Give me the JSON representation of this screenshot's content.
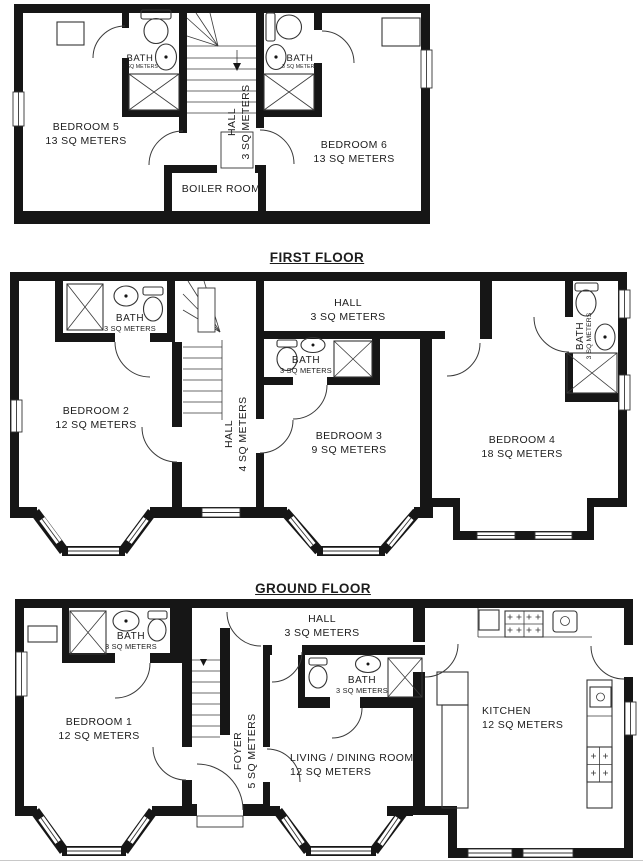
{
  "colors": {
    "wall": "#161616",
    "background": "#ffffff",
    "text": "#1c1c1c"
  },
  "headings": {
    "first_floor": "FIRST FLOOR",
    "ground_floor": "GROUND FLOOR"
  },
  "floor2": {
    "bedroom5": {
      "name": "BEDROOM 5",
      "area": "13 SQ METERS"
    },
    "bedroom6": {
      "name": "BEDROOM 6",
      "area": "13 SQ METERS"
    },
    "hall": {
      "name": "HALL",
      "area": "3 SQ METERS"
    },
    "boiler_room": {
      "name": "BOILER ROOM"
    },
    "bath_left": {
      "name": "BATH",
      "area": "3 SQ METERS"
    },
    "bath_right": {
      "name": "BATH",
      "area": "3 SQ METERS"
    }
  },
  "floor1": {
    "bedroom2": {
      "name": "BEDROOM 2",
      "area": "12 SQ METERS"
    },
    "bedroom3": {
      "name": "BEDROOM 3",
      "area": "9 SQ METERS"
    },
    "bedroom4": {
      "name": "BEDROOM 4",
      "area": "18 SQ METERS"
    },
    "hall_upper": {
      "name": "HALL",
      "area": "3 SQ METERS"
    },
    "hall_stairs": {
      "name": "HALL",
      "area": "4 SQ METERS"
    },
    "bath_left": {
      "name": "BATH",
      "area": "3 SQ METERS"
    },
    "bath_middle": {
      "name": "BATH",
      "area": "3 SQ METERS"
    },
    "bath_right": {
      "name": "BATH",
      "area": "3 SQ METERS"
    }
  },
  "ground": {
    "bedroom1": {
      "name": "BEDROOM 1",
      "area": "12 SQ METERS"
    },
    "living_dining": {
      "name": "LIVING / DINING ROOM",
      "area": "12 SQ METERS"
    },
    "kitchen": {
      "name": "KITCHEN",
      "area": "12 SQ METERS"
    },
    "foyer": {
      "name": "FOYER",
      "area": "5 SQ METERS"
    },
    "hall": {
      "name": "HALL",
      "area": "3 SQ METERS"
    },
    "bath_left": {
      "name": "BATH",
      "area": "3 SQ METERS"
    },
    "bath_middle": {
      "name": "BATH",
      "area": "3 SQ METERS"
    }
  }
}
